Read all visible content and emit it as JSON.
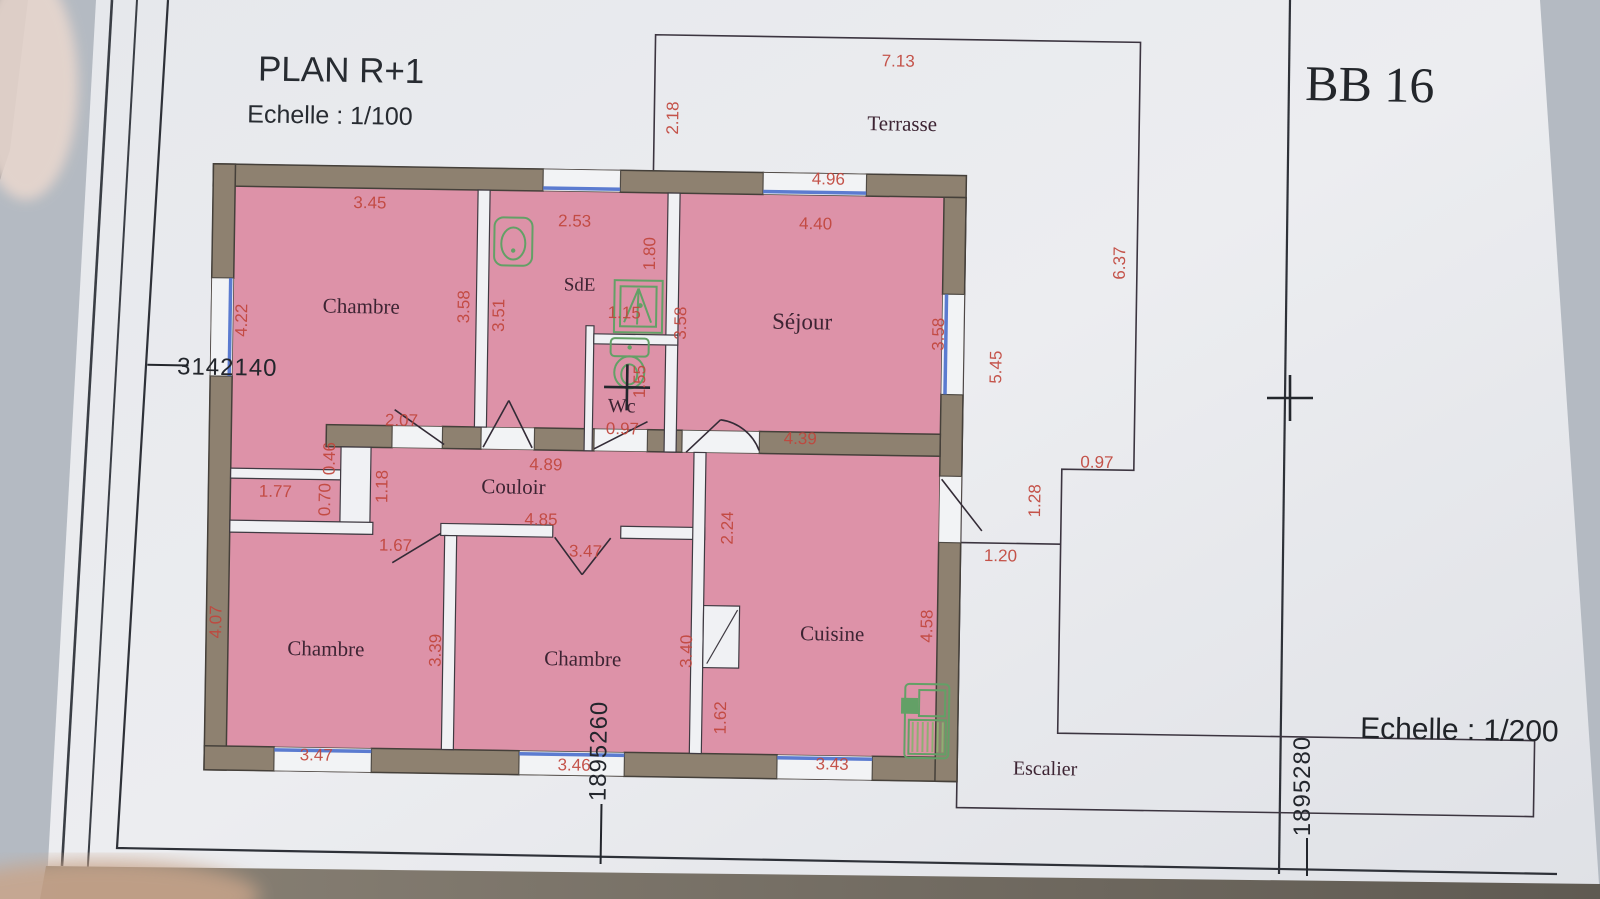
{
  "header": {
    "title": "PLAN R+1",
    "scale_label": "Echelle : 1/100",
    "sheet_ref": "BB 16",
    "scale_label_2": "Echelle : 1/200"
  },
  "grid_coordinates": {
    "x_label": "3142140",
    "y_label_bottom_center": "1895260",
    "y_label_bottom_right": "1895280"
  },
  "colors": {
    "room_fill_pink": "#dd92a8",
    "wall_brown": "#8e8170",
    "window_blue": "#5b7bd0",
    "dimension_red": "#c1463c",
    "fixture_green": "#63a066",
    "paper": "#e9ebee"
  },
  "plan": {
    "rooms": [
      {
        "t": "Terrasse",
        "x": 903,
        "y": 122,
        "s": 21
      },
      {
        "t": "Chambre",
        "x": 365,
        "y": 313,
        "s": 21
      },
      {
        "t": "SdE",
        "x": 583,
        "y": 287,
        "s": 19
      },
      {
        "t": "Séjour",
        "x": 806,
        "y": 322,
        "s": 23
      },
      {
        "t": "Wc",
        "x": 627,
        "y": 408,
        "s": 20
      },
      {
        "t": "Couloir",
        "x": 520,
        "y": 491,
        "s": 21
      },
      {
        "t": "Chambre",
        "x": 335,
        "y": 656,
        "s": 21
      },
      {
        "t": "Chambre",
        "x": 592,
        "y": 662,
        "s": 21
      },
      {
        "t": "Cuisine",
        "x": 841,
        "y": 633,
        "s": 21
      },
      {
        "t": "Escalier",
        "x": 1056,
        "y": 764,
        "s": 20
      }
    ],
    "dimensions": [
      {
        "t": "7.13",
        "x": 898,
        "y": 58,
        "rot": 0
      },
      {
        "t": "2.18",
        "x": 679,
        "y": 113,
        "rot": 1
      },
      {
        "t": "4.96",
        "x": 830,
        "y": 177,
        "rot": 0
      },
      {
        "t": "3.45",
        "x": 372,
        "y": 208,
        "rot": 0
      },
      {
        "t": "2.53",
        "x": 577,
        "y": 223,
        "rot": 0
      },
      {
        "t": "4.40",
        "x": 818,
        "y": 222,
        "rot": 0
      },
      {
        "t": "1.80",
        "x": 658,
        "y": 249,
        "rot": 1
      },
      {
        "t": "4.22",
        "x": 251,
        "y": 322,
        "rot": 1
      },
      {
        "t": "3.58",
        "x": 473,
        "y": 305,
        "rot": 1
      },
      {
        "t": "3.51",
        "x": 508,
        "y": 313,
        "rot": 1
      },
      {
        "t": "1.15",
        "x": 628,
        "y": 314,
        "rot": 0
      },
      {
        "t": "3.58",
        "x": 690,
        "y": 318,
        "rot": 1
      },
      {
        "t": "3.58",
        "x": 948,
        "y": 325,
        "rot": 1
      },
      {
        "t": "5.45",
        "x": 1006,
        "y": 357,
        "rot": 1
      },
      {
        "t": "6.37",
        "x": 1128,
        "y": 251,
        "rot": 1
      },
      {
        "t": "1.55",
        "x": 650,
        "y": 377,
        "rot": 1
      },
      {
        "t": "0.97",
        "x": 628,
        "y": 430,
        "rot": 0
      },
      {
        "t": "2.07",
        "x": 407,
        "y": 425,
        "rot": 0
      },
      {
        "t": "4.39",
        "x": 806,
        "y": 437,
        "rot": 0
      },
      {
        "t": "0.97",
        "x": 1103,
        "y": 456,
        "rot": 0
      },
      {
        "t": "4.89",
        "x": 552,
        "y": 467,
        "rot": 0
      },
      {
        "t": "1.77",
        "x": 282,
        "y": 498,
        "rot": 0
      },
      {
        "t": "0.46",
        "x": 341,
        "y": 459,
        "rot": 1
      },
      {
        "t": "0.70",
        "x": 337,
        "y": 500,
        "rot": 1
      },
      {
        "t": "1.18",
        "x": 394,
        "y": 486,
        "rot": 1
      },
      {
        "t": "1.28",
        "x": 1047,
        "y": 490,
        "rot": 1
      },
      {
        "t": "4.85",
        "x": 548,
        "y": 522,
        "rot": 0
      },
      {
        "t": "1.20",
        "x": 1008,
        "y": 551,
        "rot": 0
      },
      {
        "t": "1.67",
        "x": 403,
        "y": 550,
        "rot": 0
      },
      {
        "t": "3.47",
        "x": 593,
        "y": 553,
        "rot": 0
      },
      {
        "t": "2.24",
        "x": 740,
        "y": 522,
        "rot": 1
      },
      {
        "t": "4.07",
        "x": 230,
        "y": 624,
        "rot": 1
      },
      {
        "t": "3.39",
        "x": 450,
        "y": 649,
        "rot": 1
      },
      {
        "t": "3.40",
        "x": 701,
        "y": 646,
        "rot": 1
      },
      {
        "t": "4.58",
        "x": 941,
        "y": 617,
        "rot": 1
      },
      {
        "t": "1.62",
        "x": 736,
        "y": 712,
        "rot": 1
      },
      {
        "t": "3.47",
        "x": 327,
        "y": 761,
        "rot": 0
      },
      {
        "t": "3.46",
        "x": 585,
        "y": 767,
        "rot": 0
      },
      {
        "t": "3.43",
        "x": 843,
        "y": 762,
        "rot": 0
      }
    ],
    "fixtures": [
      "washbasin",
      "shower",
      "toilet",
      "kitchen-unit"
    ]
  }
}
